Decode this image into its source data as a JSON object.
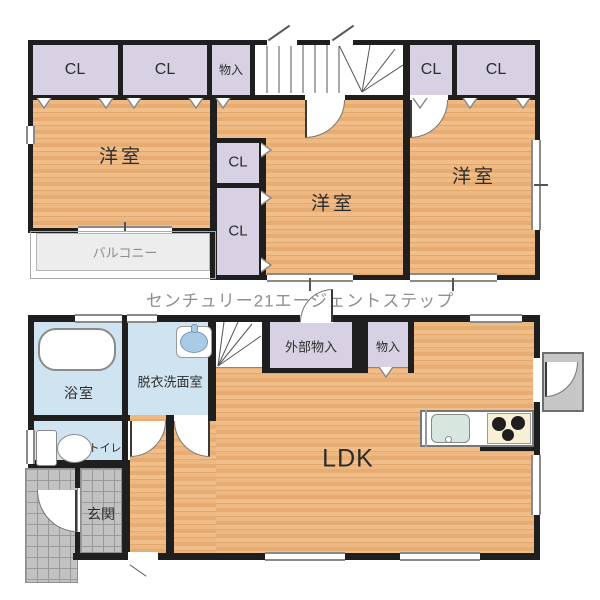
{
  "brand": "センチュリー21エージェントステップ",
  "floor2": {
    "closet": "CL",
    "storage": "物入",
    "room_left": "洋室",
    "room_center": "洋室",
    "room_right": "洋室",
    "balcony": "バルコニー"
  },
  "floor1": {
    "bathroom": "浴室",
    "washroom": "脱衣洗面室",
    "toilet": "トイレ",
    "entrance": "玄関",
    "ldk": "LDK",
    "external_storage": "外部物入",
    "storage": "物入"
  },
  "colors": {
    "wall": "#1f1f1f",
    "wood_floor": "#e9b179",
    "closet": "#d7d1e3",
    "wet_room": "#cfe3f0",
    "balcony": "#ededed",
    "tile": "#c2c2c2",
    "brand_text": "#8f8f8f"
  }
}
